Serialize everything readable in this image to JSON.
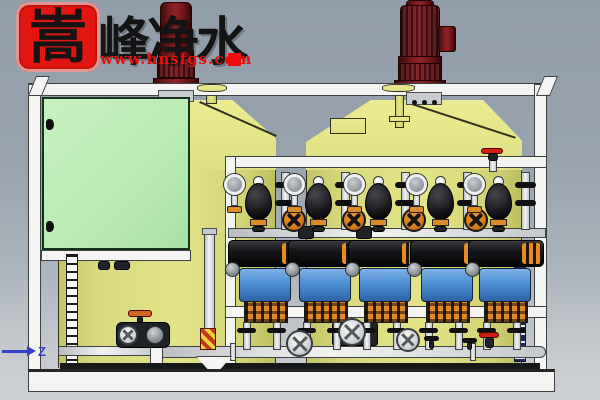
{
  "scene": {
    "description": "3D CAD render of a two-tank chemical dosing skid: yellow dosing tanks with maroon agitator motors, pale-green control cabinet, five metering pumps with pulsation dampeners, pressure gauges, back-pressure valves and white PVC piping on a white steel frame",
    "viewport_style": "CAD program viewport on grey-blue gradient background"
  },
  "watermark": {
    "seal_character": "嵩",
    "brand_characters": "峰净水",
    "website": "www.hnsfgs.com",
    "seal_color": "#e31511",
    "character_color": "#141414",
    "url_color": "#e8100c",
    "accent_square_color": "#ee0d0d"
  },
  "viewport": {
    "axis_label": "Z",
    "axis_color": "#3640c8"
  },
  "palette": {
    "background_top": "#929daa",
    "background_bottom": "#cdd0d4",
    "tank_body": "#d9da7e",
    "tank_lid": "#e6e786",
    "cabinet_green": "#bceab5",
    "frame_white": "#f4f5f2",
    "agitator_maroon": "#7c1b1e",
    "pump_motor_black": "#17171a",
    "pump_head_blue": "#4e8fd4",
    "pump_base_orange": "#de8a28",
    "dampener_black": "#131316",
    "valve_orange": "#d97c1e",
    "gauge_grey": "#9aa0a6",
    "level_gauge_navy": "#1d2a55"
  },
  "equipment": {
    "tanks": 2,
    "agitator_motors": 2,
    "dosing_pumps": 5,
    "pulsation_dampeners": 5,
    "pressure_gauges": 5,
    "back_pressure_valves": 4,
    "control_cabinets": 1,
    "level_gauges": 2
  }
}
